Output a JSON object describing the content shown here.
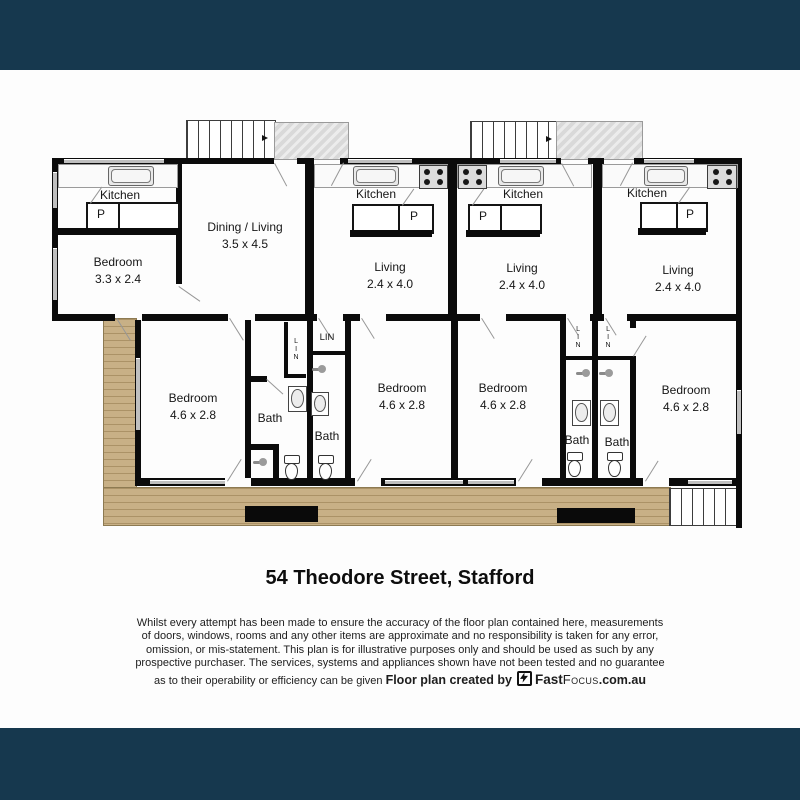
{
  "title": "54 Theodore Street, Stafford",
  "disclaimer": {
    "lines": [
      "Whilst every attempt has been made to ensure the accuracy of the floor plan contained here, measurements",
      "of doors, windows, rooms and any other items are approximate and no responsibility is taken for any error,",
      "omission, or mis-statement. This plan is for illustrative purposes only and should be used as such by any",
      "prospective purchaser. The services, systems and appliances shown have not been tested and no guarantee",
      "as to their operability or efficiency can be given"
    ]
  },
  "credit": {
    "label": "Floor plan created by",
    "brand_fast": "Fast",
    "brand_focus": "Focus",
    "brand_domain": ".com.au"
  },
  "rooms": {
    "kitchen1": {
      "label": "Kitchen"
    },
    "pantry1": {
      "label": "P"
    },
    "bedroom_u1": {
      "label": "Bedroom",
      "dims": "3.3 x 2.4"
    },
    "dining": {
      "label": "Dining / Living",
      "dims": "3.5 x 4.5"
    },
    "kitchen2": {
      "label": "Kitchen"
    },
    "pantry2": {
      "label": "P"
    },
    "living2": {
      "label": "Living",
      "dims": "2.4 x 4.0"
    },
    "kitchen3": {
      "label": "Kitchen"
    },
    "pantry3": {
      "label": "P"
    },
    "living3": {
      "label": "Living",
      "dims": "2.4 x 4.0"
    },
    "kitchen4": {
      "label": "Kitchen"
    },
    "pantry4": {
      "label": "P"
    },
    "living4": {
      "label": "Living",
      "dims": "2.4 x 4.0"
    },
    "bedroom1": {
      "label": "Bedroom",
      "dims": "4.6 x 2.8"
    },
    "bath1": {
      "label": "Bath"
    },
    "lin1": {
      "label": "LIN"
    },
    "lin2": {
      "label": "LIN"
    },
    "bath2": {
      "label": "Bath"
    },
    "bedroom2": {
      "label": "Bedroom",
      "dims": "4.6 x 2.8"
    },
    "bedroom3": {
      "label": "Bedroom",
      "dims": "4.6 x 2.8"
    },
    "lin3": {
      "label": "LIN"
    },
    "lin4": {
      "label": "LIN"
    },
    "bath3": {
      "label": "Bath"
    },
    "bath4": {
      "label": "Bath"
    },
    "bedroom4": {
      "label": "Bedroom",
      "dims": "4.6 x 2.8"
    }
  },
  "colors": {
    "banner": "#16384E",
    "deck": "#C8B086",
    "porch": "#DADADA",
    "wall": "#000000"
  }
}
